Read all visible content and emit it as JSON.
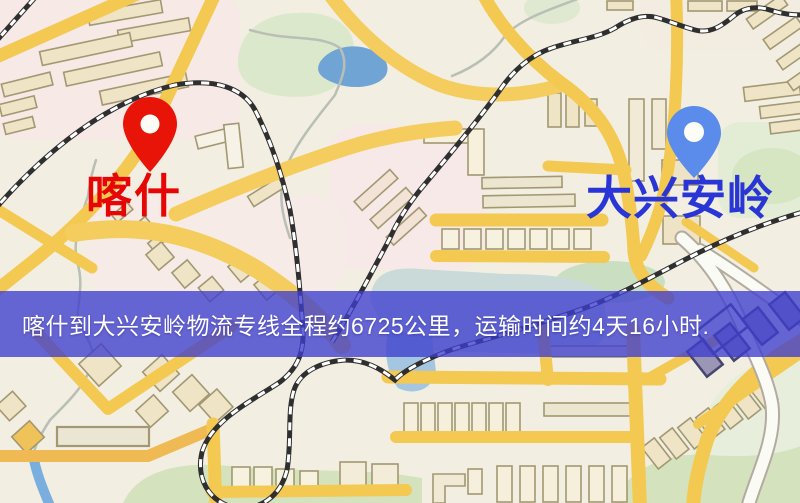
{
  "origin": {
    "name": "喀什",
    "pin_color": "#e81407",
    "label_color": "#e60606"
  },
  "destination": {
    "name": "大兴安岭",
    "pin_color": "#5b8cec",
    "label_color": "#2a35d6"
  },
  "banner": {
    "text": "喀什到大兴安岭物流专线全程约6725公里，运输时间约4天16小时.",
    "background": "rgba(62,62,206,0.78)",
    "text_color": "#ffffff"
  },
  "map": {
    "palette": {
      "background": "#f2eee2",
      "district_pink": "#f7e9e6",
      "road_yellow": "#f3c952",
      "road_orange": "#efb954",
      "building_fill": "#efe4c6",
      "building_outline": "#a29872",
      "park_green": "#d9e6c3",
      "water_blue": "#6fa4d5",
      "railway_dark": "#2f2f2f",
      "white_road": "#fbfbf6"
    }
  }
}
